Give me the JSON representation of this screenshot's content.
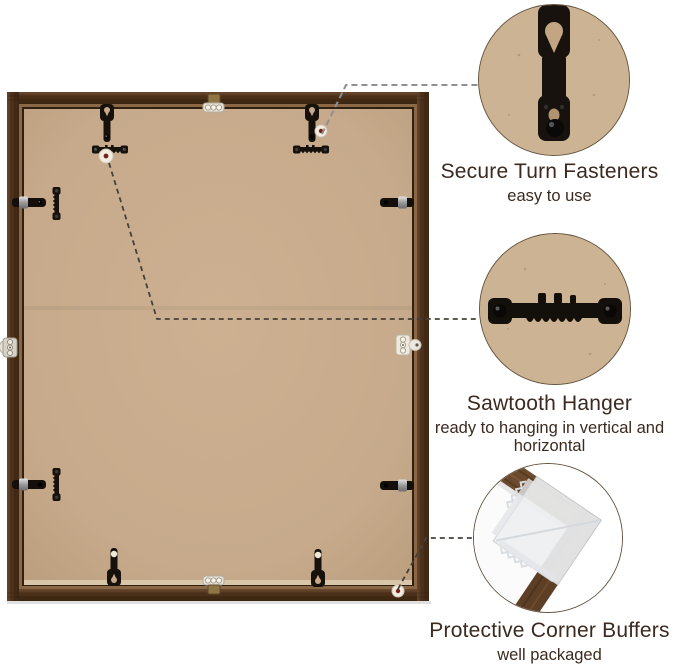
{
  "callouts": [
    {
      "id": "secure-turn-fasteners",
      "title": "Secure Turn Fasteners",
      "subtitle": "easy to use"
    },
    {
      "id": "sawtooth-hanger",
      "title": "Sawtooth Hanger",
      "subtitle": "ready to hanging in vertical and horizontal"
    },
    {
      "id": "protective-corner-buffers",
      "title": "Protective Corner Buffers",
      "subtitle": "well packaged"
    }
  ],
  "colors": {
    "page_background": "#ffffff",
    "frame_wood": "#543823",
    "frame_inner_lip": "#8a6745",
    "backing_board": "#c6aa8b",
    "hardware_black": "#17110b",
    "connector_gray": "#8f8f8f",
    "connector_dark": "#45403a",
    "text": "#3b2a1f"
  },
  "scene": {
    "hardware_icons": [
      "turn-fastener-icon",
      "sawtooth-hanger-icon",
      "spring-clip-icon",
      "nail-hole-marker-icon",
      "corner-buffer-icon"
    ]
  }
}
